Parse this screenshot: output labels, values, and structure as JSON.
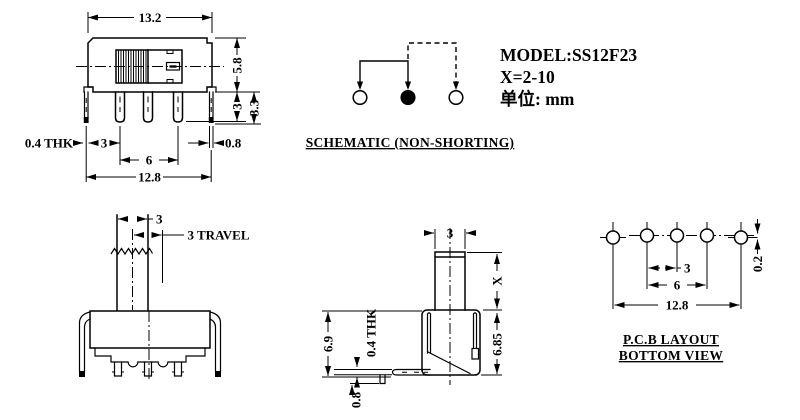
{
  "header": {
    "model": "MODEL:SS12F23",
    "x_spec": "X=2-10",
    "unit": "单位: mm"
  },
  "front_view": {
    "dim_width": "13.2",
    "dim_height": "5.8",
    "dim_pin_length": "3",
    "dim_bracket_length": "3.3",
    "dim_thickness": "0.4 THK",
    "dim_pin_pitch": "3",
    "dim_outer_pitch": "6",
    "dim_tab_width": "0.8",
    "dim_span": "12.8"
  },
  "schematic": {
    "label": "SCHEMATIC (NON-SHORTING)"
  },
  "actuator_view": {
    "dim_knob_width": "3",
    "dim_travel": "3 TRAVEL"
  },
  "profile_view": {
    "dim_knob_width": "3",
    "dim_knob_height": "X",
    "dim_body_height": "6.9",
    "dim_thickness": "0.4 THK",
    "dim_total_height": "6.85",
    "dim_pin_below": "0.8"
  },
  "pcb_view": {
    "label_line1": "P.C.B LAYOUT",
    "label_line2": "BOTTOM VIEW",
    "dim_hole_pitch": "3",
    "dim_outer_pitch": "6",
    "dim_span": "12.8",
    "dim_offset": "0.2"
  }
}
